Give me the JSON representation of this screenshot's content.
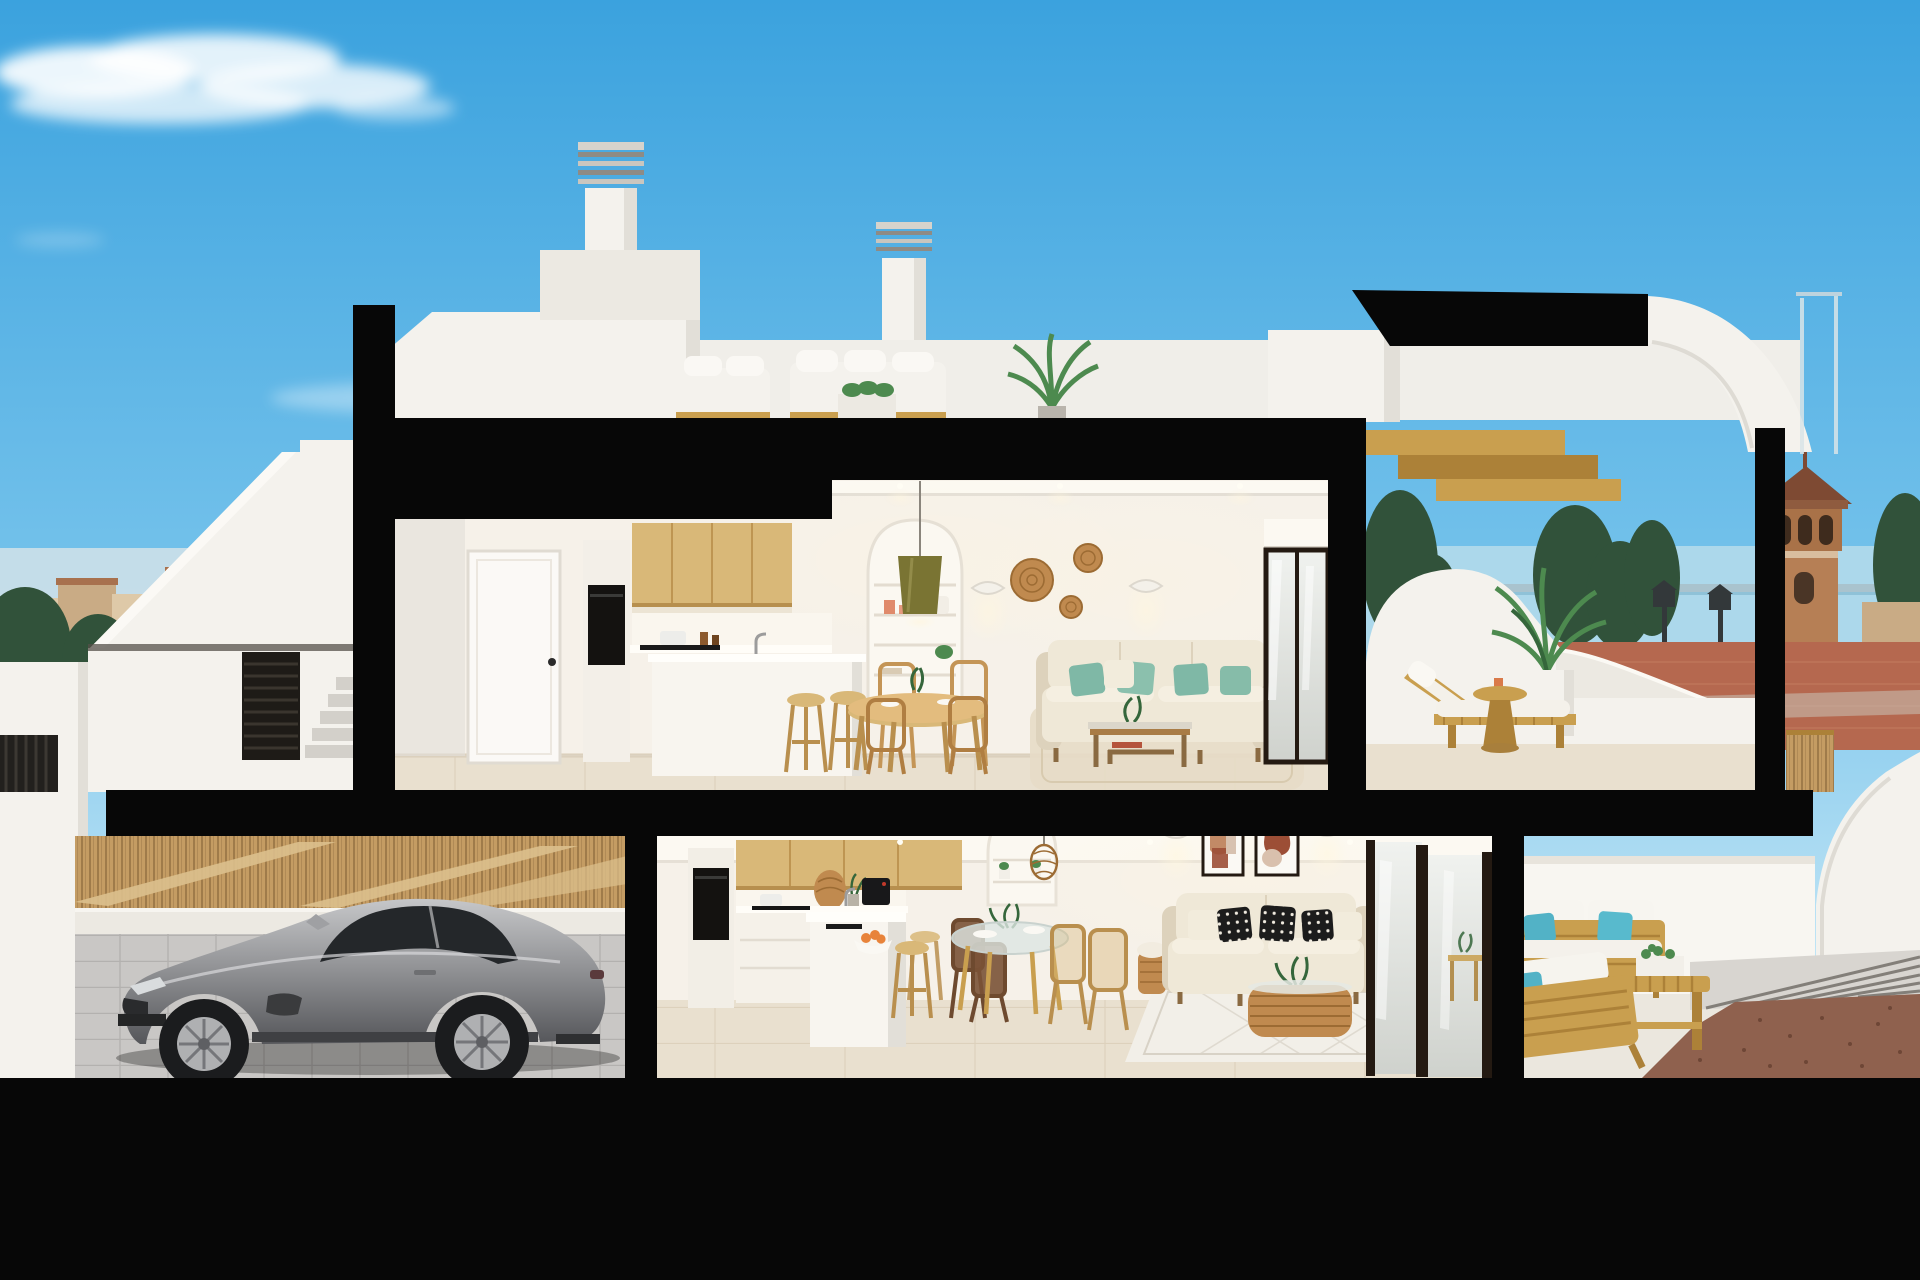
{
  "window": {
    "title": "3D cutaway render — two-storey coastal townhouse with garage"
  },
  "visible_text": [],
  "scene": {
    "type": "architectural-cutaway-render",
    "time_of_day": "day",
    "setting": "coastal town promenade",
    "levels": [
      {
        "name": "roof-terrace",
        "objects": [
          "louvered chimney",
          "second louvered chimney",
          "white outdoor lounge sofas",
          "planter box",
          "potted palm",
          "cut wooden staircase",
          "curved white sail wall",
          "glass balustrade"
        ]
      },
      {
        "name": "upper-floor",
        "objects": [
          "white interior door",
          "oven column",
          "oak wall cabinets",
          "white kitchen island",
          "two wooden stools",
          "round wooden dining table with chairs",
          "arched shelving niche",
          "olive pendant lamp",
          "two wall sconces",
          "three rattan wall discs",
          "cream sofa with teal pillows",
          "wood coffee table",
          "beige rug",
          "glass terrace door with roller blind"
        ]
      },
      {
        "name": "upper-terrace",
        "objects": [
          "wooden sun lounger with white cushion",
          "round wooden side table",
          "white cube planter with palm",
          "curved white parapet",
          "dark tree behind glass"
        ]
      },
      {
        "name": "ground-floor",
        "objects": [
          "oven column",
          "oak wall cabinets",
          "rattan dome lamp",
          "coffee machine",
          "white peninsula island with sink",
          "fruit bowl with oranges",
          "wooden bar stools",
          "glass dining table with wooden chairs",
          "arched niche with rattan pendant",
          "two abstract framed artworks",
          "two wall sconces",
          "cream sofa with black-and-white pillows",
          "wicker basket with throw",
          "rattan coffee table with plant",
          "white diamond rug",
          "sliding glass doors"
        ]
      },
      {
        "name": "ground-terrace",
        "objects": [
          "teak outdoor sofa with white cushions and turquoise pillows",
          "second teak sofa",
          "slatted bench table with succulent planter",
          "paver walkway",
          "gravel bed"
        ]
      },
      {
        "name": "garage",
        "objects": [
          "silver sports coupe",
          "bamboo slat wall with diagonal braces",
          "low white wall",
          "cobblestone floor"
        ]
      }
    ],
    "exterior": [
      "wispy cirrus cloud",
      "faint low cloud",
      "town skyline with terracotta roofs",
      "pine trees",
      "red promenade pavement",
      "pedestrian crossing",
      "blue street sign",
      "white exterior staircase with gate",
      "sea horizon",
      "brick watchtower with pyramid roof",
      "iron street lanterns",
      "timber fence",
      "white curved garden wall"
    ]
  },
  "colors": {
    "sky_top": "#3BA2DE",
    "sky_mid": "#74C2EB",
    "sky_horizon": "#C8E8F6",
    "cloud_white": "#FFFFFF",
    "cut_black": "#070707",
    "wall_white": "#F4F2ED",
    "wall_shade": "#E2DFD8",
    "interior_wall": "#F6F1E9",
    "ceiling_white": "#FCF9F2",
    "wood_cabinet": "#D9B878",
    "wood_cabinet_line": "#BE9552",
    "wood_gold": "#C99F4F",
    "wood_gold_dark": "#AC8138",
    "floor_tile": "#E9E0CF",
    "floor_line": "#D9CDB8",
    "sofa_cream": "#EFE8D7",
    "sofa_cream_dark": "#DDD2BC",
    "teal_pillow": "#7FB8A6",
    "teal_cyan": "#52B2C6",
    "rattan": "#C08A4F",
    "rattan_dark": "#9C6B33",
    "olive_lamp": "#7A7433",
    "coral_vase": "#E08A6B",
    "car_silver_light": "#C6C7C9",
    "car_silver_mid": "#8F9093",
    "car_silver_dark": "#55565A",
    "car_glass": "#24272A",
    "tire_black": "#1B1C1E",
    "bamboo": "#C49C63",
    "bamboo_line": "#8F6D3F",
    "bamboo_plank": "#DCC08D",
    "paver_gray": "#C9C7C5",
    "paver_line": "#B3B1AF",
    "low_wall": "#ECE9E2",
    "town_wall_1": "#DEC9A8",
    "town_wall_2": "#C9AB85",
    "town_roof": "#A8714E",
    "tree_dark": "#31523A",
    "tree_mid": "#4A7A50",
    "ground_red": "#B5684F",
    "ground_red_line": "#C67F63",
    "road_gray": "#93908B",
    "crossing_white": "#E9E7E1",
    "sea_blue": "#ACD8EB",
    "horizon_line": "#8FC2D8",
    "tower_brick": "#B67F55",
    "tower_roof": "#7E4A33",
    "lamp_iron": "#33383A",
    "gravel_brown": "#8F614E",
    "gravel_dark": "#6E4636",
    "frame_dark": "#241A12",
    "art_terracotta": "#C28A66",
    "art_rust": "#9C4E36",
    "glass_pale_1": "#F0F2EF",
    "glass_pale_2": "#CFD2CD",
    "orange_fruit": "#E8833A",
    "plant_green": "#4D8A4F",
    "plant_green_dark": "#35663B",
    "sign_blue": "#2E6FC0",
    "glow_warm": "#FFF6DF"
  }
}
